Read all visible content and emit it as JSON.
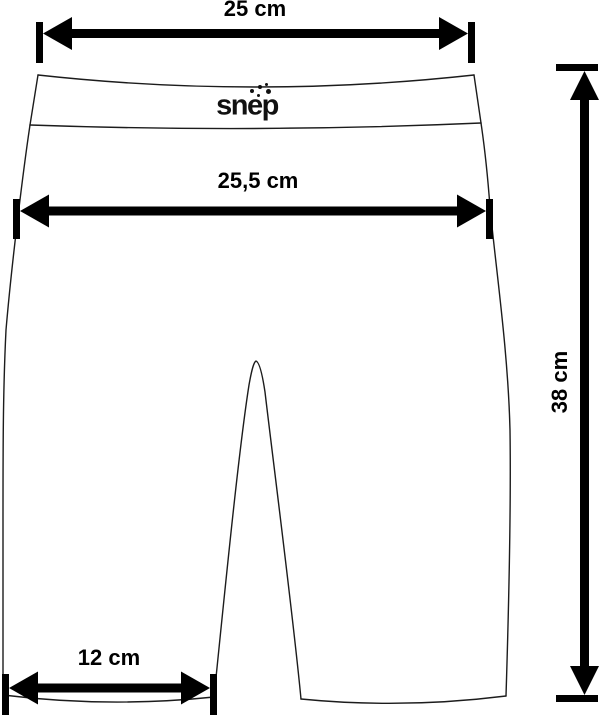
{
  "logo": {
    "text": "snep"
  },
  "measurements": {
    "top_width": {
      "label": "25 cm",
      "value": 25,
      "unit": "cm"
    },
    "waist_width": {
      "label": "25,5 cm",
      "value": 25.5,
      "unit": "cm"
    },
    "side_length": {
      "label": "38 cm",
      "value": 38,
      "unit": "cm"
    },
    "leg_hem_width": {
      "label": "12 cm",
      "value": 12,
      "unit": "cm"
    }
  },
  "colors": {
    "background": "#ffffff",
    "outline": "#1c1c1c",
    "arrow": "#000000",
    "text": "#000000"
  }
}
